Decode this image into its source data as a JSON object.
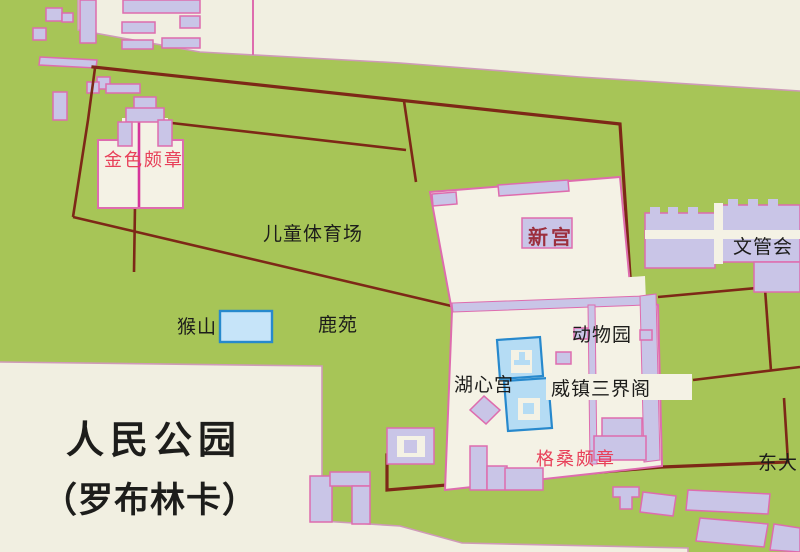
{
  "map": {
    "title": {
      "line1": "人民公园",
      "line2": "（罗布林卡）"
    },
    "labels": {
      "golden_phodrang": "金色颇章",
      "children_sports_field": "儿童体育场",
      "new_palace": "新宫",
      "culture_management_committee": "文管会",
      "monkey_hill": "猴山",
      "deer_garden": "鹿苑",
      "zoo": "动物园",
      "lake_heart_palace": "湖心宫",
      "weizhen_sanjie_pavilion": "威镇三界阁",
      "kelsang_phodrang": "格桑颇章",
      "east_gate": "东大"
    },
    "colors": {
      "park-green": "#a7c557",
      "offmap-cream": "#f1efe1",
      "compound-cream": "#f4f2e5",
      "building-lavender": "#c9c5e7",
      "outline-pink": "#de6cae",
      "edge-pink": "#cf9ab8",
      "boundary-maroon": "#7d2817",
      "path-magenta": "#d6359b",
      "water-fill": "#b5dcf4",
      "water-stroke": "#2789cd",
      "pool-fill": "#c6e4f9",
      "label-red": "#e8415a",
      "label-dark-red": "#9c2f3e",
      "label-black": "#1d1d1b"
    }
  }
}
